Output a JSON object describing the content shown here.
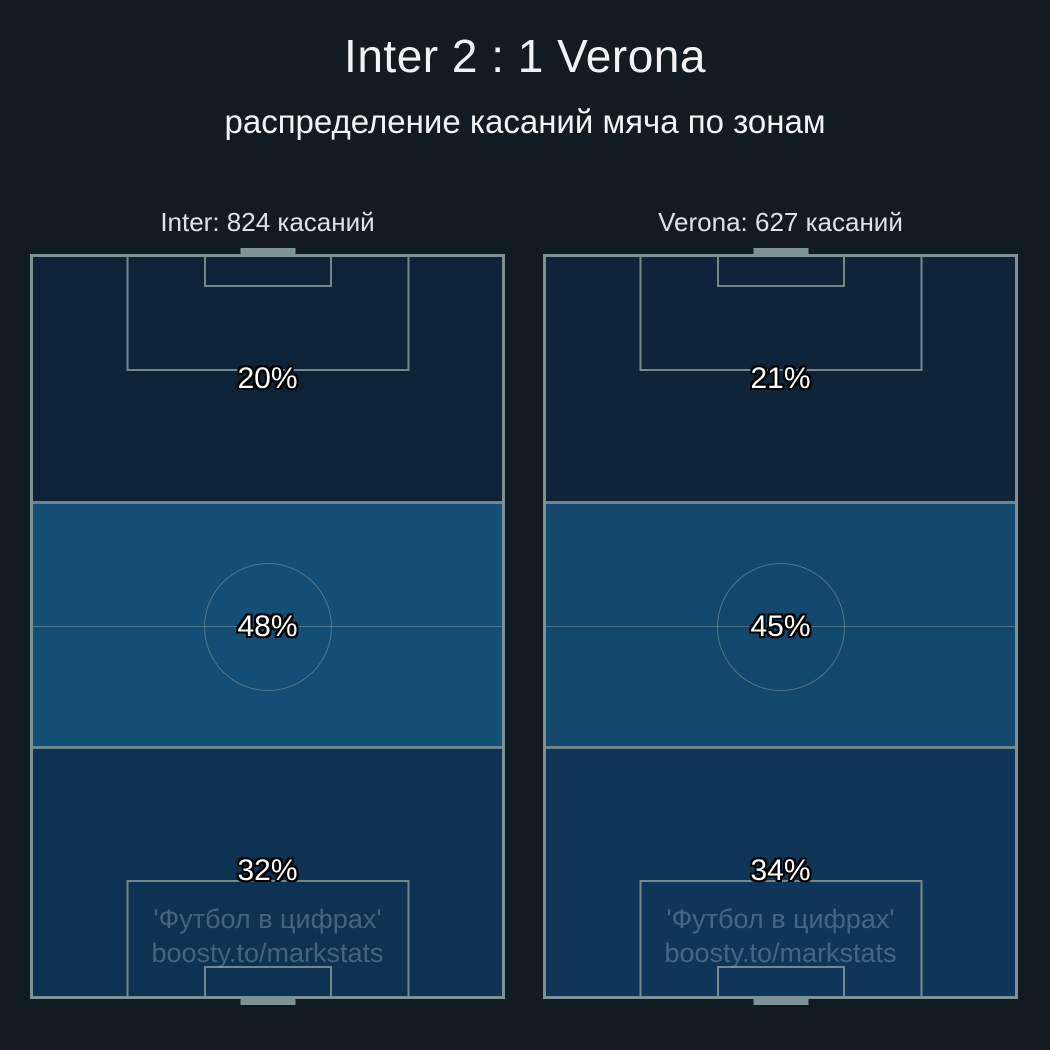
{
  "title": "Inter 2 : 1 Verona",
  "subtitle": "распределение касаний мяча по зонам",
  "teams": [
    {
      "name": "Inter",
      "header": "Inter: 824 касаний",
      "touches": 824,
      "zones": [
        {
          "zone": "attacking third",
          "pct": "20%",
          "color": "#0d2337"
        },
        {
          "zone": "middle third",
          "pct": "48%",
          "color": "#134e74"
        },
        {
          "zone": "defensive third",
          "pct": "32%",
          "color": "#0e3252"
        }
      ]
    },
    {
      "name": "Verona",
      "header": "Verona: 627 касаний",
      "touches": 627,
      "zones": [
        {
          "zone": "attacking third",
          "pct": "21%",
          "color": "#0e2439"
        },
        {
          "zone": "middle third",
          "pct": "45%",
          "color": "#11486b"
        },
        {
          "zone": "defensive third",
          "pct": "34%",
          "color": "#0f3658"
        }
      ]
    }
  ],
  "watermark": {
    "line1": "'Футбол в цифрах'",
    "line2": "boosty.to/markstats"
  },
  "colors": {
    "background": "#121a22",
    "pitch_line": "#7e9295",
    "title_text": "#f1f3f5",
    "header_text": "#dee2e6",
    "percent_text": "#ffffff",
    "percent_outline": "#000000",
    "watermark_text": "rgba(141,169,192,0.42)"
  },
  "chart_data": {
    "type": "heatmap",
    "title": "Inter 2 : 1 Verona",
    "subtitle": "распределение касаний мяча по зонам",
    "categories": [
      "attacking third (top)",
      "middle third",
      "defensive third (bottom)"
    ],
    "series": [
      {
        "name": "Inter",
        "total_touches": 824,
        "values_pct": [
          20,
          48,
          32
        ]
      },
      {
        "name": "Verona",
        "total_touches": 627,
        "values_pct": [
          21,
          45,
          34
        ]
      }
    ],
    "units": "percent of team ball touches per pitch third",
    "legend_position": "none",
    "grid": false
  }
}
